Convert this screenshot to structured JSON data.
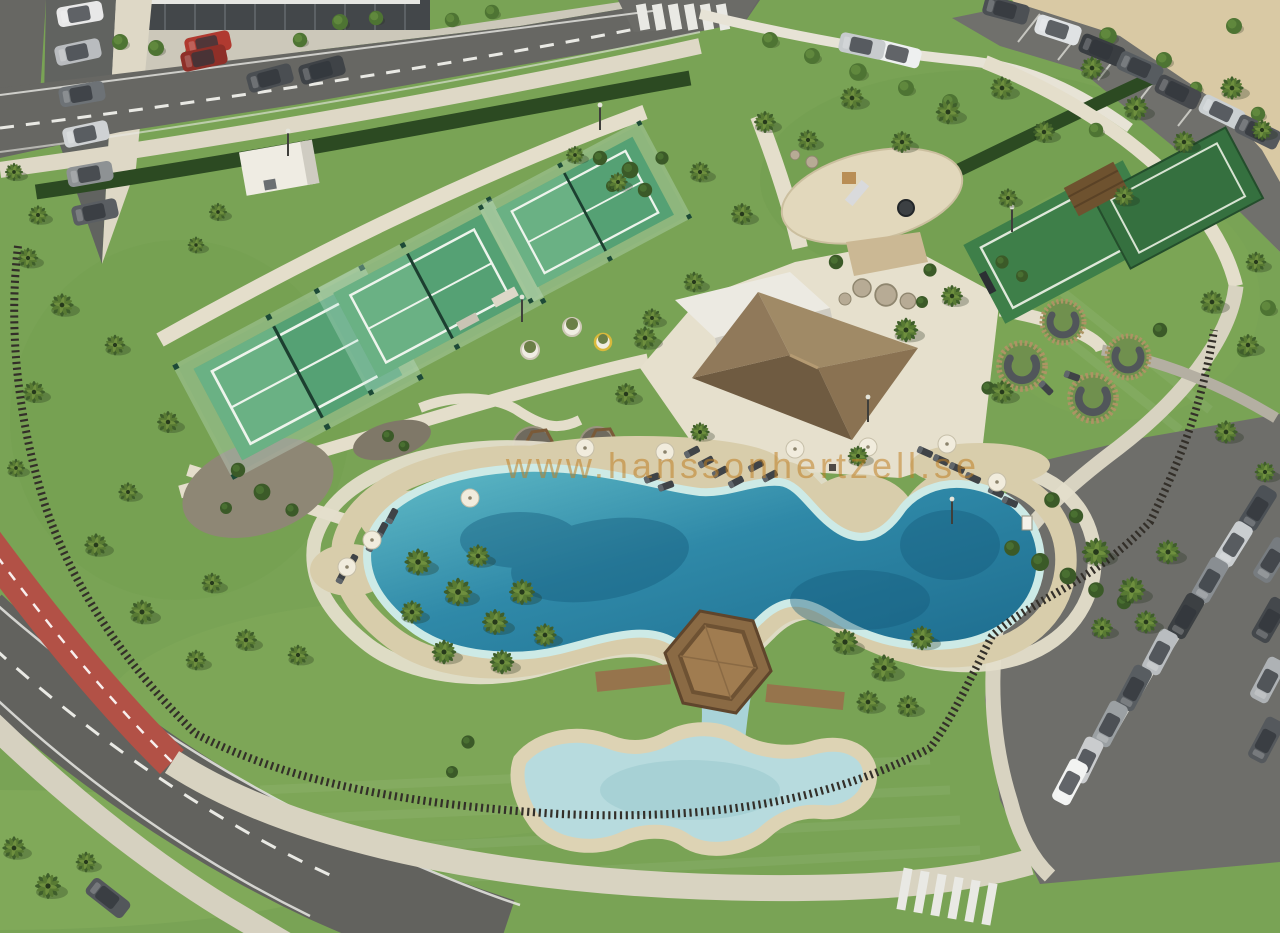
{
  "meta": {
    "description": "Aerial 3D render of a resort community park: three padel courts, lagoon-style pool with kids pool and hexagonal wooden gazebo deck, clubhouse with thatched hip roof, playground, round wooden seating pods, palm-filled lawns, red bike lane on curving road, and two car parks.",
    "width": 1280,
    "height": 933
  },
  "watermark": {
    "text": "www.hanssonhertzell.se",
    "color": "#c08025"
  },
  "palette": {
    "grass": "#79a355",
    "grass_light": "#a9c673",
    "road_asphalt": "#676763",
    "sidewalk_cream": "#e4decb",
    "sand_beach": "#d8cdab",
    "sand_lot": "#d9c9a4",
    "water_deep": "#1d6c8e",
    "water_mid": "#2f89a8",
    "water_shallow": "#cdeae6",
    "kids_pool": "#b7dbde",
    "bike_path_red": "#b25146",
    "court_green": "#55a174",
    "sport_court_green": "#3e7f49",
    "roof_thatch": "#8a7354",
    "roof_white": "#eceae2",
    "fence_dark": "#332f29",
    "hedge_dark": "#2c4a22",
    "wood_deck": "#96744c"
  },
  "scene": {
    "labels": {
      "pool": "lagoon swimming pool",
      "kids_pool": "children's pool",
      "gazebo": "hexagonal wooden deck",
      "padel_courts": "padel courts",
      "clubhouse": "clubhouse pavilion",
      "playground": "playground",
      "bike_lane": "red bike lane",
      "parking": "parking lots"
    },
    "instances": {
      "palm": [
        [
          28,
          258,
          0.8
        ],
        [
          62,
          305,
          0.9
        ],
        [
          34,
          392,
          0.85
        ],
        [
          16,
          468,
          0.7
        ],
        [
          96,
          545,
          0.9
        ],
        [
          142,
          612,
          0.95
        ],
        [
          196,
          660,
          0.8
        ],
        [
          246,
          640,
          0.85
        ],
        [
          298,
          655,
          0.8
        ],
        [
          14,
          172,
          0.7
        ],
        [
          38,
          215,
          0.75
        ],
        [
          115,
          345,
          0.8
        ],
        [
          168,
          422,
          0.85
        ],
        [
          128,
          492,
          0.75
        ],
        [
          212,
          583,
          0.8
        ],
        [
          218,
          212,
          0.7
        ],
        [
          196,
          245,
          0.65
        ],
        [
          575,
          155,
          0.7
        ],
        [
          618,
          182,
          0.75
        ],
        [
          700,
          172,
          0.8
        ],
        [
          742,
          214,
          0.85
        ],
        [
          694,
          282,
          0.8
        ],
        [
          652,
          318,
          0.75
        ],
        [
          765,
          122,
          0.85
        ],
        [
          808,
          140,
          0.8
        ],
        [
          852,
          98,
          0.9
        ],
        [
          902,
          142,
          0.85
        ],
        [
          948,
          112,
          0.95
        ],
        [
          1002,
          88,
          0.9
        ],
        [
          1044,
          132,
          0.85
        ],
        [
          1092,
          68,
          0.9
        ],
        [
          1136,
          108,
          0.95
        ],
        [
          1184,
          142,
          0.85
        ],
        [
          1232,
          88,
          0.9
        ],
        [
          1262,
          130,
          0.8
        ],
        [
          1008,
          198,
          0.75
        ],
        [
          1124,
          196,
          0.8
        ],
        [
          1212,
          302,
          0.9
        ],
        [
          1256,
          262,
          0.8
        ],
        [
          1248,
          345,
          0.85
        ],
        [
          1226,
          432,
          0.9
        ],
        [
          1265,
          472,
          0.8
        ],
        [
          645,
          338,
          0.9
        ],
        [
          626,
          394,
          0.85
        ],
        [
          906,
          330,
          0.95
        ],
        [
          952,
          296,
          0.85
        ],
        [
          1002,
          392,
          0.9
        ],
        [
          858,
          456,
          0.8
        ],
        [
          700,
          432,
          0.75
        ],
        [
          418,
          562,
          1.05
        ],
        [
          458,
          592,
          1.1
        ],
        [
          495,
          622,
          1.0
        ],
        [
          444,
          652,
          0.95
        ],
        [
          412,
          612,
          0.9
        ],
        [
          478,
          556,
          0.9
        ],
        [
          522,
          592,
          1.0
        ],
        [
          502,
          662,
          0.95
        ],
        [
          545,
          635,
          0.9
        ],
        [
          1096,
          552,
          1.1
        ],
        [
          1132,
          590,
          1.05
        ],
        [
          1168,
          552,
          0.95
        ],
        [
          1146,
          622,
          0.9
        ],
        [
          1102,
          628,
          0.85
        ],
        [
          845,
          642,
          1.0
        ],
        [
          884,
          668,
          1.05
        ],
        [
          922,
          638,
          0.95
        ],
        [
          868,
          702,
          0.9
        ],
        [
          908,
          706,
          0.85
        ],
        [
          14,
          848,
          0.9
        ],
        [
          48,
          886,
          1.0
        ],
        [
          86,
          862,
          0.8
        ]
      ],
      "tree": [
        [
          120,
          42,
          1
        ],
        [
          156,
          48,
          1
        ],
        [
          192,
          54,
          0.9
        ],
        [
          300,
          40,
          0.9
        ],
        [
          340,
          22,
          1
        ],
        [
          376,
          18,
          0.9
        ],
        [
          452,
          20,
          0.9
        ],
        [
          492,
          12,
          0.9
        ],
        [
          770,
          40,
          1
        ],
        [
          812,
          56,
          1
        ],
        [
          858,
          72,
          1.1
        ],
        [
          906,
          88,
          1
        ],
        [
          950,
          102,
          1
        ],
        [
          1108,
          36,
          1.1
        ],
        [
          1164,
          60,
          1
        ],
        [
          1234,
          26,
          1
        ],
        [
          1096,
          130,
          0.9
        ],
        [
          1258,
          114,
          0.9
        ],
        [
          1196,
          88,
          0.8
        ],
        [
          1268,
          308,
          1
        ],
        [
          1244,
          350,
          0.9
        ]
      ],
      "bush": [
        [
          600,
          158,
          1.2
        ],
        [
          630,
          170,
          1.4
        ],
        [
          662,
          158,
          1.1
        ],
        [
          612,
          186,
          1
        ],
        [
          645,
          190,
          1.2
        ],
        [
          1012,
          548,
          1.3
        ],
        [
          1040,
          562,
          1.5
        ],
        [
          1068,
          576,
          1.4
        ],
        [
          1096,
          590,
          1.3
        ],
        [
          1124,
          602,
          1.2
        ],
        [
          836,
          262,
          1.2
        ],
        [
          930,
          270,
          1.1
        ],
        [
          922,
          302,
          1
        ],
        [
          988,
          388,
          1.1
        ],
        [
          1160,
          330,
          1.2
        ],
        [
          1052,
          500,
          1.3
        ],
        [
          1076,
          516,
          1.2
        ],
        [
          238,
          470,
          1.2
        ],
        [
          262,
          492,
          1.4
        ],
        [
          292,
          510,
          1.1
        ],
        [
          226,
          508,
          1
        ],
        [
          388,
          436,
          1
        ],
        [
          404,
          446,
          0.9
        ],
        [
          468,
          742,
          1.1
        ],
        [
          452,
          772,
          1
        ],
        [
          1002,
          262,
          1.1
        ],
        [
          1022,
          276,
          1
        ]
      ],
      "rock": [
        [
          862,
          288,
          1.5
        ],
        [
          886,
          295,
          1.8
        ],
        [
          908,
          301,
          1.3
        ],
        [
          845,
          299,
          1
        ],
        [
          812,
          162,
          1
        ],
        [
          795,
          155,
          0.8
        ]
      ],
      "pod": [
        [
          1063,
          322,
          1.0
        ],
        [
          1022,
          366,
          1.1
        ],
        [
          1128,
          357,
          1.0
        ],
        [
          1093,
          398,
          1.1
        ]
      ],
      "court": [
        [
          298,
          372,
          1.08,
          -28
        ],
        [
          430,
          296,
          1.0,
          -28
        ],
        [
          585,
          212,
          0.92,
          -28
        ]
      ],
      "car": [
        [
          80,
          14,
          -10,
          "#e8e8e8"
        ],
        [
          78,
          52,
          -12,
          "#b9bcbf"
        ],
        [
          82,
          94,
          -10,
          "#6d7276"
        ],
        [
          86,
          134,
          -12,
          "#cfd2d4"
        ],
        [
          90,
          174,
          -10,
          "#8e9294"
        ],
        [
          95,
          212,
          -12,
          "#5a5e62"
        ],
        [
          270,
          78,
          -15,
          "#4a4e52"
        ],
        [
          322,
          70,
          -15,
          "#3f4347"
        ],
        [
          208,
          44,
          -12,
          "#b03a30"
        ],
        [
          204,
          58,
          -12,
          "#8e2f28"
        ],
        [
          898,
          54,
          14,
          "#eef0f0"
        ],
        [
          862,
          46,
          12,
          "#c7cbcd"
        ],
        [
          1058,
          30,
          18,
          "#dfe2e4"
        ],
        [
          1006,
          10,
          15,
          "#4c5054"
        ],
        [
          1102,
          50,
          22,
          "#393d41"
        ],
        [
          1140,
          68,
          24,
          "#575c60"
        ],
        [
          1178,
          92,
          26,
          "#46494d"
        ],
        [
          1222,
          112,
          26,
          "#cbd0d2"
        ],
        [
          1258,
          132,
          26,
          "#55595d"
        ],
        [
          1258,
          508,
          -58,
          "#4c5156"
        ],
        [
          1234,
          544,
          -58,
          "#caced0"
        ],
        [
          1210,
          580,
          -60,
          "#898e92"
        ],
        [
          1186,
          616,
          -60,
          "#3c4043"
        ],
        [
          1160,
          652,
          -62,
          "#b9bdc0"
        ],
        [
          1134,
          688,
          -62,
          "#585d61"
        ],
        [
          1110,
          724,
          -62,
          "#9ba0a3"
        ],
        [
          1086,
          760,
          -64,
          "#caccce"
        ],
        [
          1070,
          782,
          -62,
          "#f2f3f2"
        ],
        [
          1272,
          560,
          -58,
          "#777c80"
        ],
        [
          1270,
          620,
          -60,
          "#44484c"
        ],
        [
          1268,
          680,
          -62,
          "#aeb2b5"
        ],
        [
          1266,
          740,
          -62,
          "#55595d"
        ],
        [
          108,
          898,
          38,
          "#53575b"
        ]
      ],
      "lounger": [
        [
          692,
          452,
          -28
        ],
        [
          706,
          462,
          -28
        ],
        [
          720,
          472,
          -28
        ],
        [
          736,
          482,
          -28
        ],
        [
          756,
          466,
          -28
        ],
        [
          770,
          476,
          -28
        ],
        [
          925,
          452,
          24
        ],
        [
          941,
          460,
          24
        ],
        [
          957,
          468,
          24
        ],
        [
          973,
          478,
          24
        ],
        [
          996,
          492,
          24
        ],
        [
          1010,
          502,
          24
        ],
        [
          392,
          516,
          -62
        ],
        [
          382,
          530,
          -62
        ],
        [
          372,
          544,
          -62
        ],
        [
          352,
          562,
          -62
        ],
        [
          342,
          576,
          -62
        ],
        [
          652,
          478,
          -20
        ],
        [
          666,
          486,
          -20
        ],
        [
          1072,
          376,
          20
        ],
        [
          1046,
          388,
          45
        ]
      ],
      "umbrella": [
        [
          585,
          448
        ],
        [
          665,
          452
        ],
        [
          470,
          498
        ],
        [
          372,
          540
        ],
        [
          347,
          567
        ],
        [
          947,
          444
        ],
        [
          997,
          482
        ],
        [
          795,
          449
        ],
        [
          868,
          447
        ]
      ],
      "pole": [
        [
          600,
          130
        ],
        [
          522,
          322
        ],
        [
          1012,
          232
        ],
        [
          868,
          422
        ],
        [
          288,
          156
        ],
        [
          952,
          524
        ]
      ]
    }
  }
}
